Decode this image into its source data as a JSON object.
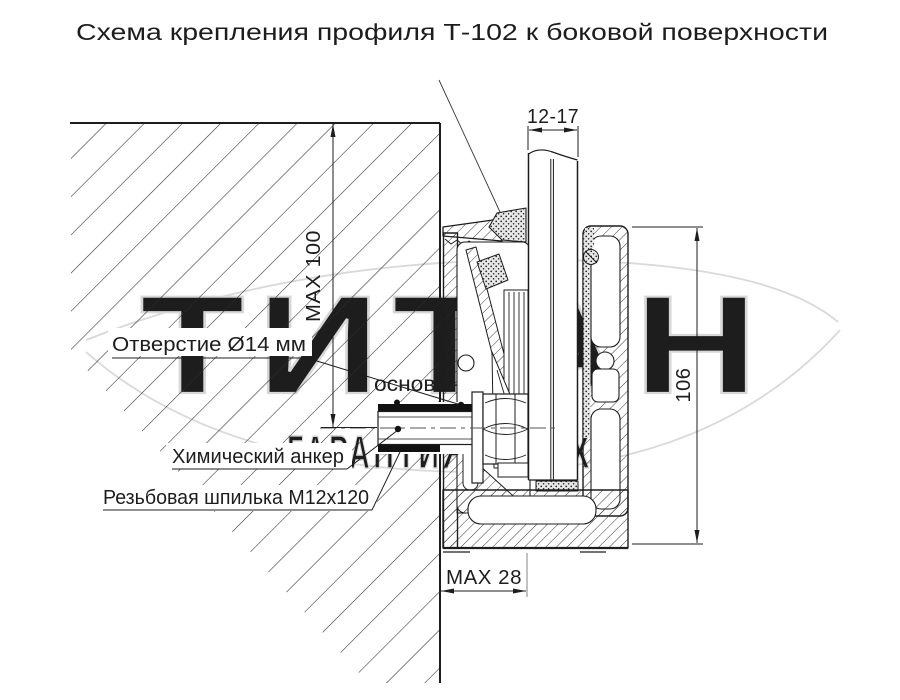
{
  "title": "Схема крепления профиля Т-102 к боковой поверхности",
  "dimensions": {
    "glass_thickness": "12-17",
    "hole_depth_max": "MAX 100",
    "profile_height": "106",
    "edge_distance_max": "MAX 28"
  },
  "callouts": {
    "hole": "Отверстие Ø14 мм",
    "chemical_anchor": "Химический анкер",
    "threaded_stud": "Резьбовая шпилька М12х120"
  },
  "watermark": {
    "brand": "ТИТАН",
    "subtitle": "основан в 2005",
    "slogan": "ГАРАНТИЯ УСПЕХА"
  },
  "colors": {
    "ink": "#1d1d1d",
    "paper": "#ffffff",
    "watermark": "#d7d7d7",
    "watermark_solid": "#d0d0d0",
    "centerline": "#555555"
  }
}
